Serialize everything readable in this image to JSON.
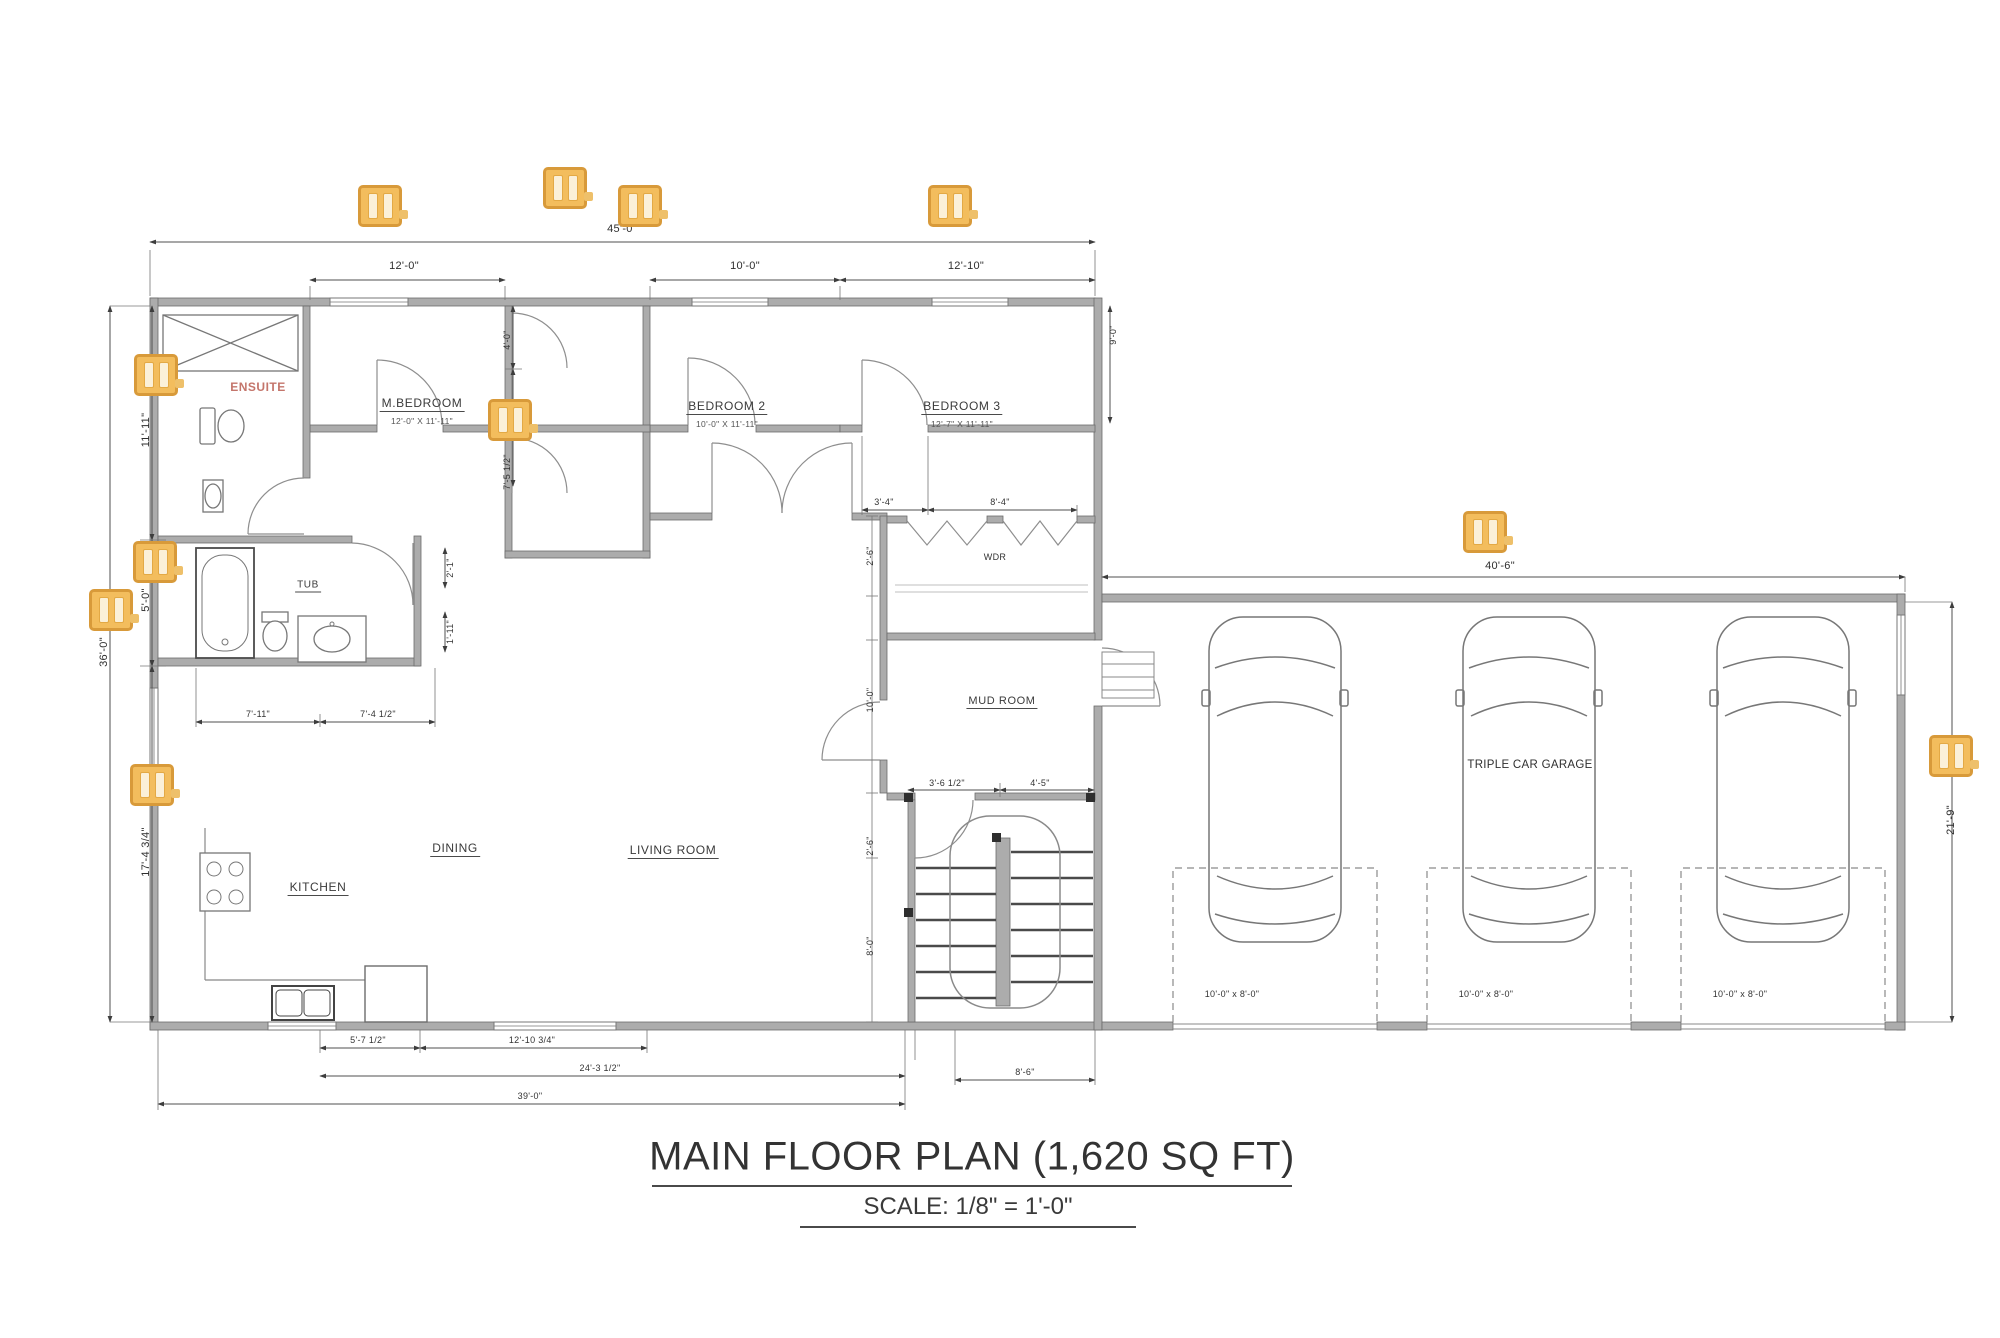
{
  "title": {
    "main": "MAIN FLOOR PLAN (1,620 SQ FT)",
    "scale": "SCALE: 1/8\" = 1'-0\""
  },
  "rooms": {
    "master": {
      "label": "M.BEDROOM",
      "size": "12'-0\" X 11'-11\""
    },
    "bedroom2": {
      "label": "BEDROOM 2",
      "size": "10'-0\" X 11'-11\""
    },
    "bedroom3": {
      "label": "BEDROOM 3",
      "size": "12'-7\" X 11'-11\""
    },
    "ensuite": {
      "label": "ENSUITE"
    },
    "bath": {
      "label": "TUB"
    },
    "closet": {
      "label": "WDR"
    },
    "mudroom": {
      "label": "MUD ROOM"
    },
    "kitchen": {
      "label": "KITCHEN"
    },
    "dining": {
      "label": "DINING"
    },
    "living": {
      "label": "LIVING ROOM"
    },
    "garage": {
      "label": "TRIPLE CAR GARAGE"
    }
  },
  "dims": {
    "top_overall": "45'-0\"",
    "top_master": "12'-0\"",
    "top_bed2": "10'-0\"",
    "top_bed3": "12'-10\"",
    "garage_width": "40'-6\"",
    "garage_depth": "21'-9\"",
    "left_upper": "11'-11\"",
    "left_mid": "5'-0\"",
    "left_overall": "36'-0\"",
    "left_lower": "17'-4 3/4\"",
    "closet_upper": "4'-0\"",
    "closet_lower": "7'-5 1/2\"",
    "bed3_door": "3'-4\"",
    "bed3_closet": "8'-4\"",
    "bath_left": "7'-11\"",
    "bath_right": "7'-4 1/2\"",
    "bath_small_upper": "2'-1\"",
    "bath_small_lower": "1'-11\"",
    "stair_left": "3'-6 1/2\"",
    "stair_right": "4'-5\"",
    "mud_col_1": "2'-6\"",
    "mud_col_2": "10'-0\"",
    "mud_col_3": "2'-6\"",
    "mud_col_4": "8'-0\"",
    "bed3_depth": "9'-0\"",
    "bottom_1": "5'-7 1/2\"",
    "bottom_2": "12'-10 3/4\"",
    "bottom_3": "24'-3 1/2\"",
    "bottom_4": "39'-0\"",
    "bottom_5": "8'-6\""
  },
  "garage_bays": [
    "10'-0\" x 8'-0\"",
    "10'-0\" x 8'-0\"",
    "10'-0\" x 8'-0\""
  ],
  "colors": {
    "marker_border": "#D89A3A",
    "marker_fill": "#F3BD5D",
    "ensuite_text": "#C4756B",
    "wall": "#ACACAC",
    "line": "#4F4F4F"
  }
}
